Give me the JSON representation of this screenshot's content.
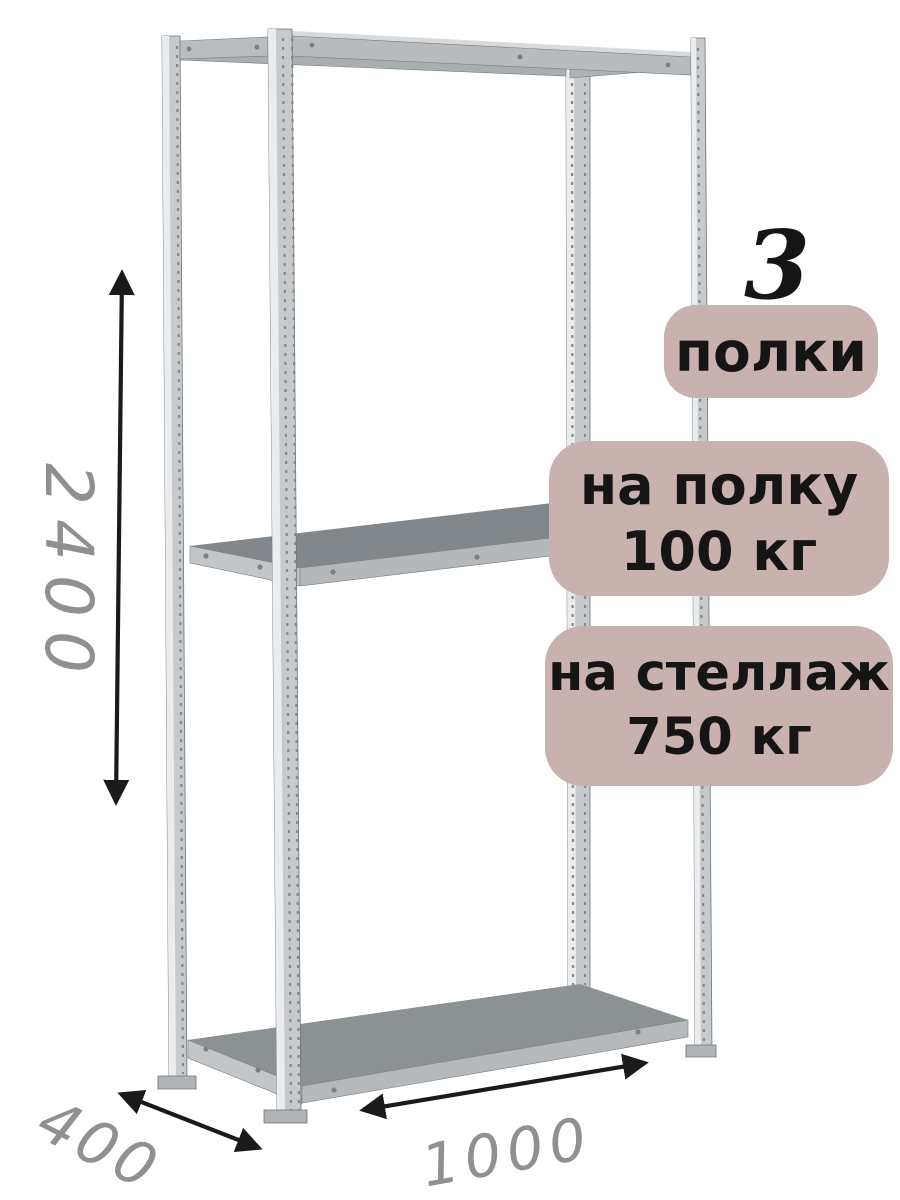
{
  "product_labels": {
    "shelf_count_value": "3",
    "shelf_count_unit": "полки",
    "shelf_load": {
      "line1": "на полку",
      "line2": "100 кг"
    },
    "rack_load": {
      "line1": "на стеллаж",
      "line2": "750 кг"
    }
  },
  "dimensions_mm": {
    "height": "2400",
    "depth": "400",
    "width": "1000"
  },
  "colors": {
    "background": "#ffffff",
    "badge_background": "#c9b1b0",
    "label_text": "#151515",
    "dimension_text": "#909092",
    "arrow": "#1a1a1a",
    "metal_light": "#eaecee",
    "metal_mid": "#c7cacd",
    "metal_beam": "#b7bbbe",
    "shelf_top_dark": "#82878b"
  }
}
